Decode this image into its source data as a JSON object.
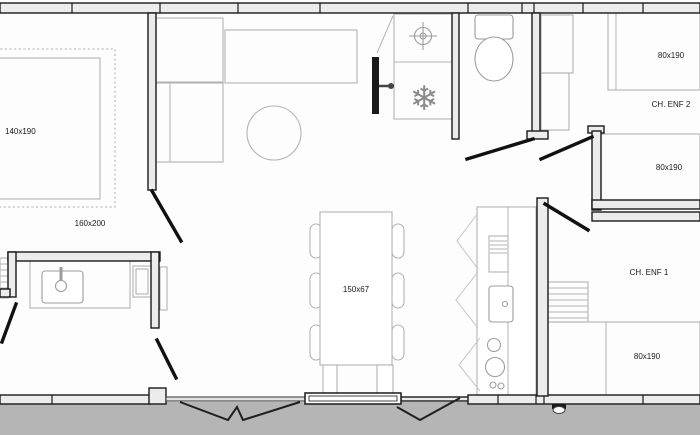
{
  "colors": {
    "background": "#fdfdfd",
    "ground": "#b5b5b5",
    "wall_fill": "#ececec",
    "wall_stroke": "#1a1a1a",
    "furniture_stroke": "#b3b3b3",
    "door_leaf": "#111111",
    "text": "#1a1a1a"
  },
  "labels": {
    "master_bed_size": "140x190",
    "master_room_size": "160x200",
    "dining_table_size": "150x67",
    "kids2_bed_top_size": "80x190",
    "kids2_room_name": "CH. ENF 2",
    "kids2_bed_mid_size": "80x190",
    "kids1_room_name": "CH. ENF 1",
    "kids1_bed_size": "80x190"
  },
  "icons": {
    "freezer_glyph": "❄"
  }
}
